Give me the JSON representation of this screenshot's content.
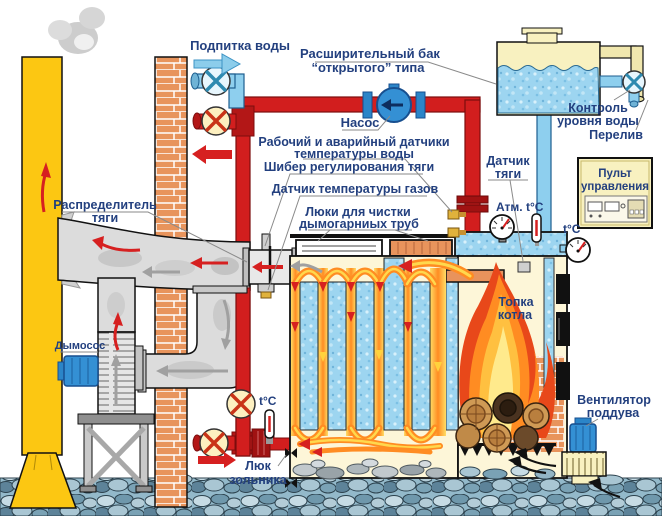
{
  "diagram_labels": {
    "water_makeup": "Подпитка воды",
    "expansion_tank_line1": "Расширительный бак",
    "expansion_tank_line2": "“открытого” типа",
    "pump": "Насос",
    "water_temp_sensors_line1": "Рабочий и аварийный датчики",
    "water_temp_sensors_line2": "температуры воды",
    "draft_damper": "Шибер регулирования тяги",
    "gas_temp_sensor": "Датчик температуры газов",
    "cleaning_hatches_line1": "Люки для чистки",
    "cleaning_hatches_line2": "дымогарниых труб",
    "draft_sensor_line1": "Датчик",
    "draft_sensor_line2": "тяги",
    "control_panel_line1": "Пульт",
    "control_panel_line2": "управления",
    "water_level_line1": "Контроль",
    "water_level_line2": "уровня воды",
    "overflow": "Перелив",
    "draft_distributor_line1": "Распределитель",
    "draft_distributor_line2": "тяги",
    "smoke_exhauster": "Дымосос",
    "firebox_line1": "Топка",
    "firebox_line2": "котла",
    "blower_fan_line1": "Вентилятор",
    "blower_fan_line2": "поддува",
    "ash_hatch_line1": "Люк",
    "ash_hatch_line2": "зольника",
    "pressure_gauge": "Атм.",
    "temp_gauge": "t°C"
  },
  "colors": {
    "hot_pipe_red": "#d21e1e",
    "cold_pipe_blue": "#8ecfee",
    "water_fill": "#9dd5f0",
    "flame_orange": "#ff8c22",
    "flame_red": "#e8481a",
    "flame_yellow": "#ffc040",
    "label_navy": "#23407f",
    "chimney_yellow": "#fcc712",
    "brick_orange": "#e8945c",
    "panel_cream": "#f8f1c0",
    "duct_gray": "#dcdcdc",
    "motor_blue": "#3490d4"
  }
}
